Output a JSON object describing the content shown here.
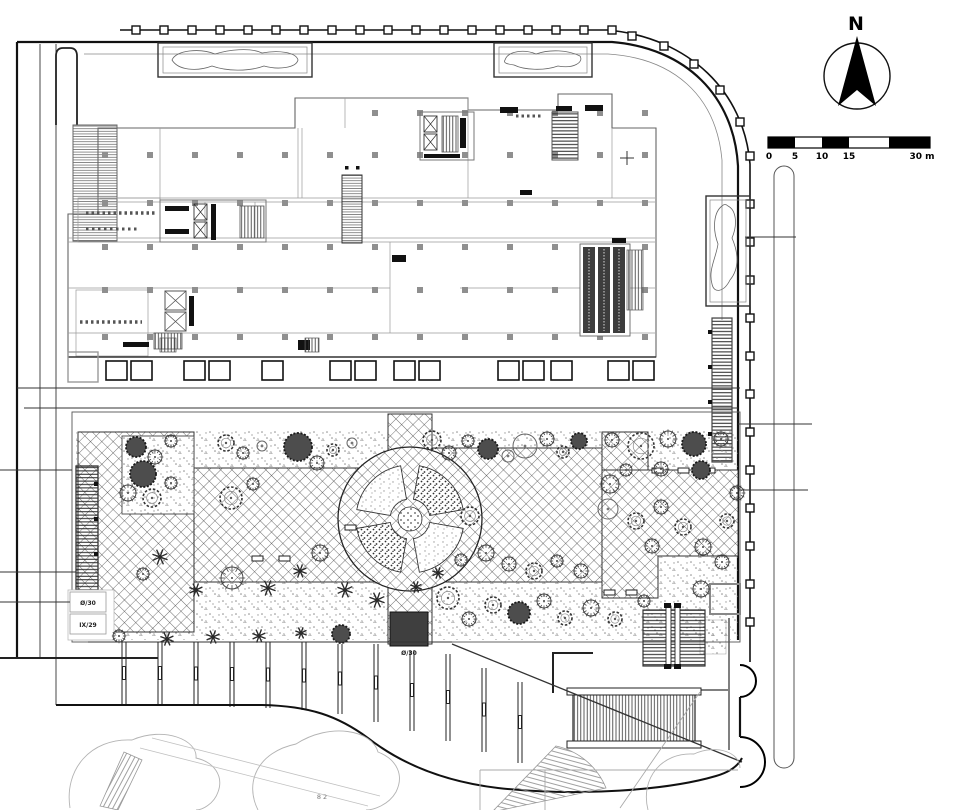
{
  "drawing": {
    "kind": "architectural ground-floor site / landscape plan",
    "north_label": "N",
    "scale_bar": {
      "labels": [
        "0",
        "5",
        "10",
        "15"
      ],
      "end_label": "30 m"
    },
    "annotations": {
      "level_box_top": "Ø/30",
      "level_box_bottom": "IX/29",
      "south_entry_level": "Ø/30",
      "adjacent_label": "8 2"
    }
  },
  "trees": [
    {
      "x": 136,
      "y": 447,
      "r": 10,
      "t": "d"
    },
    {
      "x": 155,
      "y": 457,
      "r": 7,
      "t": "s"
    },
    {
      "x": 171,
      "y": 441,
      "r": 6,
      "t": "s"
    },
    {
      "x": 226,
      "y": 443,
      "r": 8,
      "t": "c"
    },
    {
      "x": 243,
      "y": 453,
      "r": 6,
      "t": "s"
    },
    {
      "x": 262,
      "y": 446,
      "r": 5,
      "t": "o"
    },
    {
      "x": 298,
      "y": 447,
      "r": 14,
      "t": "d"
    },
    {
      "x": 317,
      "y": 463,
      "r": 7,
      "t": "s"
    },
    {
      "x": 333,
      "y": 450,
      "r": 6,
      "t": "c"
    },
    {
      "x": 352,
      "y": 443,
      "r": 5,
      "t": "o"
    },
    {
      "x": 432,
      "y": 440,
      "r": 9,
      "t": "c"
    },
    {
      "x": 449,
      "y": 453,
      "r": 7,
      "t": "s"
    },
    {
      "x": 468,
      "y": 441,
      "r": 6,
      "t": "s"
    },
    {
      "x": 488,
      "y": 449,
      "r": 10,
      "t": "d"
    },
    {
      "x": 508,
      "y": 456,
      "r": 6,
      "t": "o"
    },
    {
      "x": 525,
      "y": 446,
      "r": 12,
      "t": "o"
    },
    {
      "x": 547,
      "y": 439,
      "r": 7,
      "t": "s"
    },
    {
      "x": 563,
      "y": 452,
      "r": 6,
      "t": "c"
    },
    {
      "x": 579,
      "y": 441,
      "r": 8,
      "t": "d"
    },
    {
      "x": 612,
      "y": 440,
      "r": 7,
      "t": "s"
    },
    {
      "x": 641,
      "y": 446,
      "r": 13,
      "t": "c"
    },
    {
      "x": 668,
      "y": 439,
      "r": 8,
      "t": "s"
    },
    {
      "x": 694,
      "y": 444,
      "r": 12,
      "t": "d"
    },
    {
      "x": 721,
      "y": 439,
      "r": 7,
      "t": "s"
    },
    {
      "x": 143,
      "y": 474,
      "r": 13,
      "t": "d"
    },
    {
      "x": 128,
      "y": 493,
      "r": 8,
      "t": "s"
    },
    {
      "x": 152,
      "y": 498,
      "r": 9,
      "t": "c"
    },
    {
      "x": 171,
      "y": 483,
      "r": 6,
      "t": "s"
    },
    {
      "x": 231,
      "y": 498,
      "r": 11,
      "t": "c"
    },
    {
      "x": 253,
      "y": 484,
      "r": 6,
      "t": "s"
    },
    {
      "x": 320,
      "y": 553,
      "r": 8,
      "t": "s"
    },
    {
      "x": 300,
      "y": 571,
      "r": 7,
      "t": "p"
    },
    {
      "x": 268,
      "y": 588,
      "r": 8,
      "t": "p"
    },
    {
      "x": 232,
      "y": 578,
      "r": 11,
      "t": "s"
    },
    {
      "x": 196,
      "y": 590,
      "r": 7,
      "t": "p"
    },
    {
      "x": 160,
      "y": 557,
      "r": 8,
      "t": "p"
    },
    {
      "x": 143,
      "y": 574,
      "r": 6,
      "t": "s"
    },
    {
      "x": 345,
      "y": 590,
      "r": 8,
      "t": "p"
    },
    {
      "x": 377,
      "y": 600,
      "r": 8,
      "t": "p"
    },
    {
      "x": 470,
      "y": 516,
      "r": 9,
      "t": "c"
    },
    {
      "x": 486,
      "y": 553,
      "r": 8,
      "t": "s"
    },
    {
      "x": 509,
      "y": 564,
      "r": 7,
      "t": "s"
    },
    {
      "x": 534,
      "y": 571,
      "r": 8,
      "t": "c"
    },
    {
      "x": 557,
      "y": 561,
      "r": 6,
      "t": "s"
    },
    {
      "x": 581,
      "y": 571,
      "r": 7,
      "t": "s"
    },
    {
      "x": 610,
      "y": 484,
      "r": 9,
      "t": "s"
    },
    {
      "x": 608,
      "y": 509,
      "r": 10,
      "t": "o"
    },
    {
      "x": 636,
      "y": 521,
      "r": 8,
      "t": "c"
    },
    {
      "x": 661,
      "y": 507,
      "r": 7,
      "t": "s"
    },
    {
      "x": 683,
      "y": 527,
      "r": 8,
      "t": "c"
    },
    {
      "x": 652,
      "y": 546,
      "r": 7,
      "t": "s"
    },
    {
      "x": 703,
      "y": 547,
      "r": 8,
      "t": "s"
    },
    {
      "x": 727,
      "y": 521,
      "r": 7,
      "t": "c"
    },
    {
      "x": 737,
      "y": 493,
      "r": 7,
      "t": "s"
    },
    {
      "x": 701,
      "y": 470,
      "r": 9,
      "t": "d"
    },
    {
      "x": 661,
      "y": 469,
      "r": 7,
      "t": "s"
    },
    {
      "x": 626,
      "y": 470,
      "r": 6,
      "t": "s"
    },
    {
      "x": 448,
      "y": 598,
      "r": 11,
      "t": "c"
    },
    {
      "x": 469,
      "y": 619,
      "r": 7,
      "t": "s"
    },
    {
      "x": 493,
      "y": 605,
      "r": 8,
      "t": "c"
    },
    {
      "x": 519,
      "y": 613,
      "r": 11,
      "t": "d"
    },
    {
      "x": 544,
      "y": 601,
      "r": 7,
      "t": "s"
    },
    {
      "x": 565,
      "y": 618,
      "r": 7,
      "t": "c"
    },
    {
      "x": 591,
      "y": 608,
      "r": 8,
      "t": "s"
    },
    {
      "x": 615,
      "y": 619,
      "r": 7,
      "t": "c"
    },
    {
      "x": 644,
      "y": 601,
      "r": 6,
      "t": "s"
    },
    {
      "x": 416,
      "y": 587,
      "r": 6,
      "t": "p"
    },
    {
      "x": 438,
      "y": 573,
      "r": 6,
      "t": "p"
    },
    {
      "x": 461,
      "y": 560,
      "r": 6,
      "t": "s"
    },
    {
      "x": 341,
      "y": 634,
      "r": 9,
      "t": "d"
    },
    {
      "x": 301,
      "y": 633,
      "r": 6,
      "t": "p"
    },
    {
      "x": 259,
      "y": 636,
      "r": 7,
      "t": "p"
    },
    {
      "x": 213,
      "y": 637,
      "r": 7,
      "t": "p"
    },
    {
      "x": 167,
      "y": 639,
      "r": 7,
      "t": "p"
    },
    {
      "x": 119,
      "y": 636,
      "r": 6,
      "t": "s"
    },
    {
      "x": 701,
      "y": 589,
      "r": 8,
      "t": "s"
    },
    {
      "x": 722,
      "y": 562,
      "r": 7,
      "t": "s"
    }
  ]
}
